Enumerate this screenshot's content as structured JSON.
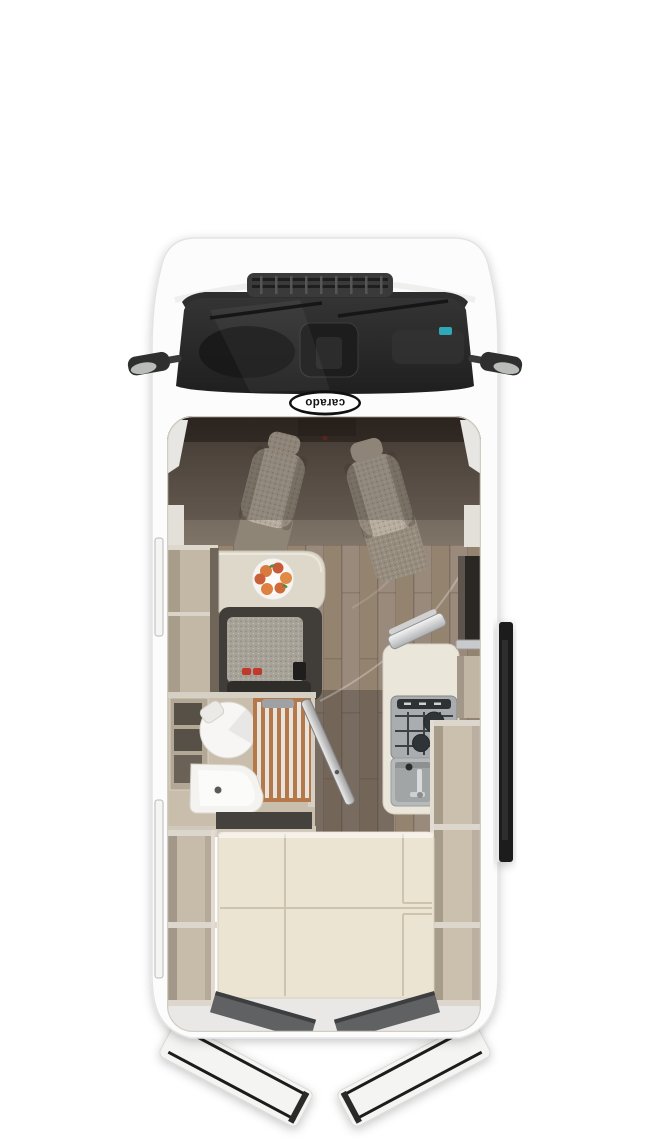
{
  "page": {
    "background": "#ffffff",
    "description": "Top-down cutaway floor plan render of a Carado camper van shown with open rear doors and open side sliding door"
  },
  "brand": {
    "logo_text": "carado"
  },
  "vehicle": {
    "type": "camper-van floor plan",
    "view": "top-down cutaway"
  },
  "areas": {
    "cab": {
      "label": "Driver cab",
      "seats": 2,
      "details": [
        "two swivel seats",
        "dashboard",
        "windshield with wipers",
        "two exterior mirrors"
      ]
    },
    "dinette": {
      "label": "Half-dinette",
      "details": [
        "side table",
        "plate with fruit",
        "bench seat",
        "two red seat-belt buckles"
      ]
    },
    "bathroom": {
      "label": "Compact bathroom",
      "details": [
        "round cassette toilet",
        "wood-slat shower tray",
        "corner washbasin",
        "open bathroom door"
      ]
    },
    "kitchen": {
      "label": "Kitchenette",
      "details": [
        "two-burner hob with grid",
        "square sink with faucet",
        "raised glass lid",
        "white countertop"
      ]
    },
    "bedroom": {
      "label": "Rear transverse bed",
      "details": [
        "cream mattress cushions with seams",
        "open wardrobe shelves left",
        "open wardrobe shelves right"
      ]
    },
    "doors": {
      "rear_doors": "open",
      "sliding_door": "open",
      "bathroom_door": "open"
    },
    "windows": {
      "left_wall_slots": 2
    }
  },
  "colors": {
    "body_white": "#fcfcfc",
    "windshield_dark": "#2b2b2b",
    "interior_wall_beige": "#c7bbaa",
    "floor_wood": "#9a8a7c",
    "bed_cream": "#ece4d3",
    "shower_wood": "#b5784a",
    "seat_fabric": "#b7ad9f",
    "bench_dark": "#413e3a",
    "stove_grey": "#a9adb0",
    "fruit_orange": "#d97b3f",
    "buckle_red": "#c0392b",
    "sliding_door_dark": "#1d1d1d"
  }
}
